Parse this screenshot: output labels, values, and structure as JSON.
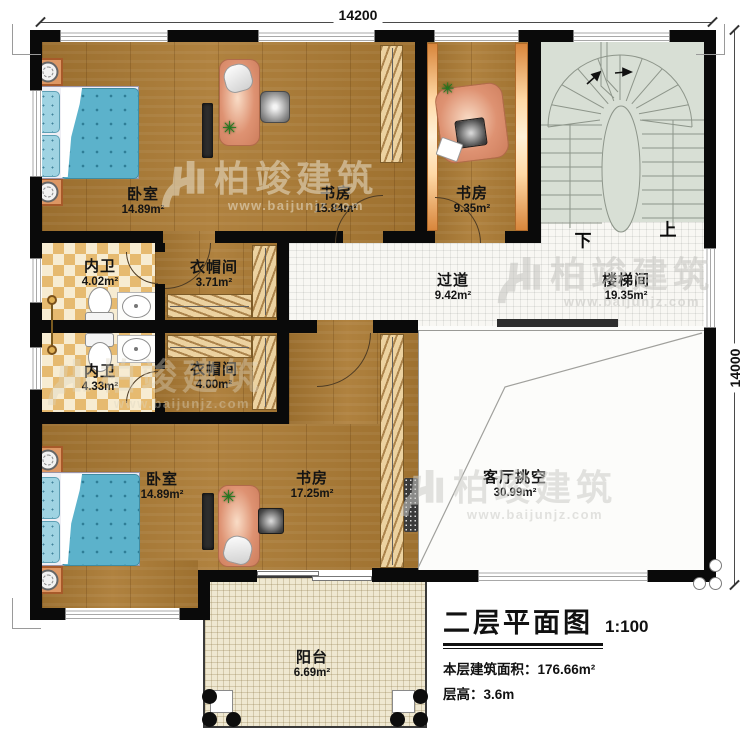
{
  "dimensions": {
    "top": "14200",
    "right": "14000"
  },
  "rooms": [
    {
      "name": "卧室",
      "area": "14.89m²"
    },
    {
      "name": "书房",
      "area": "15.84m²"
    },
    {
      "name": "书房",
      "area": "9.35m²"
    },
    {
      "name": "楼梯间",
      "area": "19.35m²"
    },
    {
      "name": "过道",
      "area": "9.42m²"
    },
    {
      "name": "内卫",
      "area": "4.02m²"
    },
    {
      "name": "衣帽间",
      "area": "3.71m²"
    },
    {
      "name": "内卫",
      "area": "4.33m²"
    },
    {
      "name": "衣帽间",
      "area": "4.00m²"
    },
    {
      "name": "卧室",
      "area": "14.89m²"
    },
    {
      "name": "书房",
      "area": "17.25m²"
    },
    {
      "name": "客厅挑空",
      "area": "30.99m²"
    },
    {
      "name": "阳台",
      "area": "6.69m²"
    }
  ],
  "stairs": {
    "down": "下",
    "up": "上"
  },
  "watermark": {
    "brand": "柏竣建筑",
    "url": "www.baijunjz.com"
  },
  "titleblock": {
    "title": "二层平面图",
    "scale": "1:100",
    "area_label": "本层建筑面积：",
    "area_value": "176.66m²",
    "height_label": "层高：",
    "height_value": "3.6m"
  },
  "colors": {
    "wall": "#0a0a0a",
    "wood": "#ab7a33",
    "stair_floor": "#d8dfd5",
    "accent_desk": "#de9272"
  }
}
